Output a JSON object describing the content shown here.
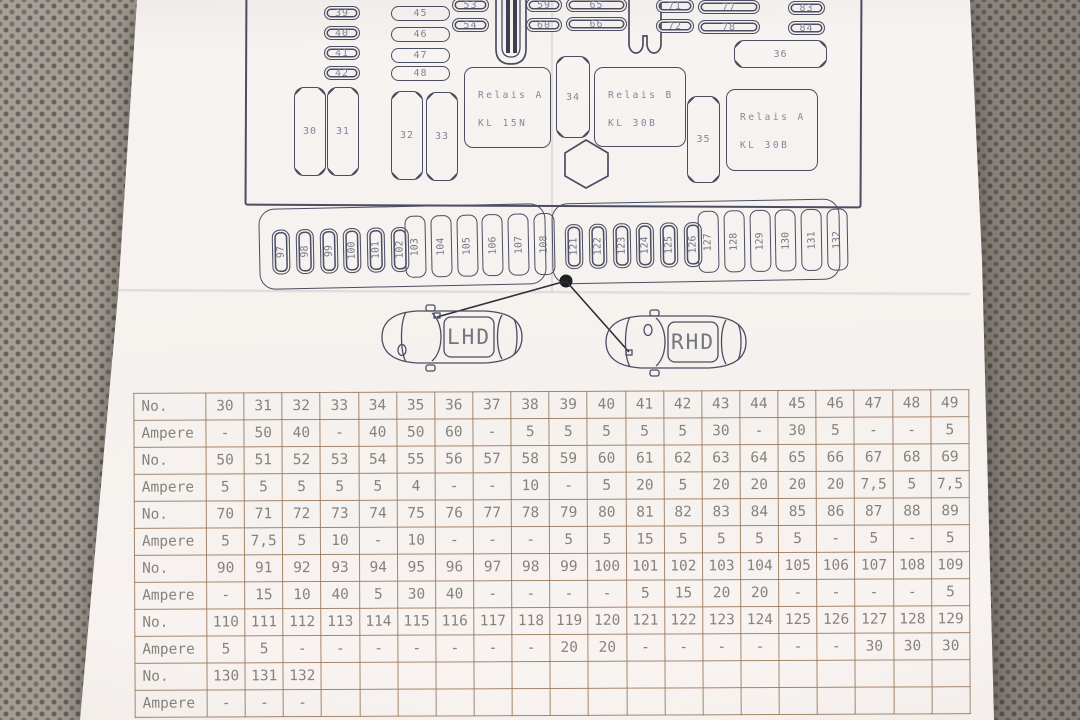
{
  "background": {
    "fabric_base": "#9c958d",
    "fabric_dot": "#6f675f",
    "paper": "#f5f1ee",
    "diagram_ink": "#4b4d63",
    "table_line": "#9c8673"
  },
  "diagram": {
    "relay_a15": {
      "line1": "Relais A",
      "line2": "KL 15N"
    },
    "relay_b30": {
      "line1": "Relais B",
      "line2": "KL 30B"
    },
    "relay_a30": {
      "line1": "Relais A",
      "line2": "KL 30B"
    },
    "col_39_42": [
      "39",
      "40",
      "41",
      "42"
    ],
    "col_45_48": [
      "45",
      "46",
      "47",
      "48"
    ],
    "pairs": [
      [
        "53",
        "54"
      ],
      [
        "59",
        "60"
      ],
      [
        "65",
        "66"
      ],
      [
        "71",
        "72"
      ],
      [
        "77",
        "78"
      ],
      [
        "83",
        "84"
      ]
    ],
    "big_fuses": [
      "30",
      "31",
      "32",
      "33"
    ],
    "fuse_34": "34",
    "fuse_35": "35",
    "fuse_36": "36",
    "strip_left": {
      "small": [
        "97",
        "98",
        "99",
        "100",
        "101",
        "102"
      ],
      "tall": [
        "103",
        "104",
        "105",
        "106",
        "107",
        "108"
      ]
    },
    "strip_right": {
      "small": [
        "121",
        "122",
        "123",
        "124",
        "125",
        "126"
      ],
      "tall": [
        "127",
        "128",
        "129",
        "130",
        "131",
        "132"
      ]
    }
  },
  "cars": {
    "left_label": "LHD",
    "right_label": "RHD"
  },
  "table": {
    "no_label": "No.",
    "ampere_label": "Ampere",
    "rows": [
      {
        "nos": [
          "30",
          "31",
          "32",
          "33",
          "34",
          "35",
          "36",
          "37",
          "38",
          "39",
          "40",
          "41",
          "42",
          "43",
          "44",
          "45",
          "46",
          "47",
          "48",
          "49"
        ],
        "amps": [
          "-",
          "50",
          "40",
          "-",
          "40",
          "50",
          "60",
          "-",
          "5",
          "5",
          "5",
          "5",
          "5",
          "30",
          "-",
          "30",
          "5",
          "-",
          "-",
          "5"
        ]
      },
      {
        "nos": [
          "50",
          "51",
          "52",
          "53",
          "54",
          "55",
          "56",
          "57",
          "58",
          "59",
          "60",
          "61",
          "62",
          "63",
          "64",
          "65",
          "66",
          "67",
          "68",
          "69"
        ],
        "amps": [
          "5",
          "5",
          "5",
          "5",
          "5",
          "4",
          "-",
          "-",
          "10",
          "-",
          "5",
          "20",
          "5",
          "20",
          "20",
          "20",
          "20",
          "7,5",
          "5",
          "7,5"
        ]
      },
      {
        "nos": [
          "70",
          "71",
          "72",
          "73",
          "74",
          "75",
          "76",
          "77",
          "78",
          "79",
          "80",
          "81",
          "82",
          "83",
          "84",
          "85",
          "86",
          "87",
          "88",
          "89"
        ],
        "amps": [
          "5",
          "7,5",
          "5",
          "10",
          "-",
          "10",
          "-",
          "-",
          "-",
          "5",
          "5",
          "15",
          "5",
          "5",
          "5",
          "5",
          "-",
          "5",
          "-",
          "5"
        ]
      },
      {
        "nos": [
          "90",
          "91",
          "92",
          "93",
          "94",
          "95",
          "96",
          "97",
          "98",
          "99",
          "100",
          "101",
          "102",
          "103",
          "104",
          "105",
          "106",
          "107",
          "108",
          "109"
        ],
        "amps": [
          "-",
          "15",
          "10",
          "40",
          "5",
          "30",
          "40",
          "-",
          "-",
          "-",
          "-",
          "5",
          "15",
          "20",
          "20",
          "-",
          "-",
          "-",
          "-",
          "5"
        ]
      },
      {
        "nos": [
          "110",
          "111",
          "112",
          "113",
          "114",
          "115",
          "116",
          "117",
          "118",
          "119",
          "120",
          "121",
          "122",
          "123",
          "124",
          "125",
          "126",
          "127",
          "128",
          "129"
        ],
        "amps": [
          "5",
          "5",
          "-",
          "-",
          "-",
          "-",
          "-",
          "-",
          "-",
          "20",
          "20",
          "-",
          "-",
          "-",
          "-",
          "-",
          "-",
          "30",
          "30",
          "30"
        ]
      },
      {
        "nos": [
          "130",
          "131",
          "132",
          "",
          "",
          "",
          "",
          "",
          "",
          "",
          "",
          "",
          "",
          "",
          "",
          "",
          "",
          "",
          "",
          ""
        ],
        "amps": [
          "-",
          "-",
          "-",
          "",
          "",
          "",
          "",
          "",
          "",
          "",
          "",
          "",
          "",
          "",
          "",
          "",
          "",
          "",
          "",
          ""
        ]
      }
    ]
  }
}
